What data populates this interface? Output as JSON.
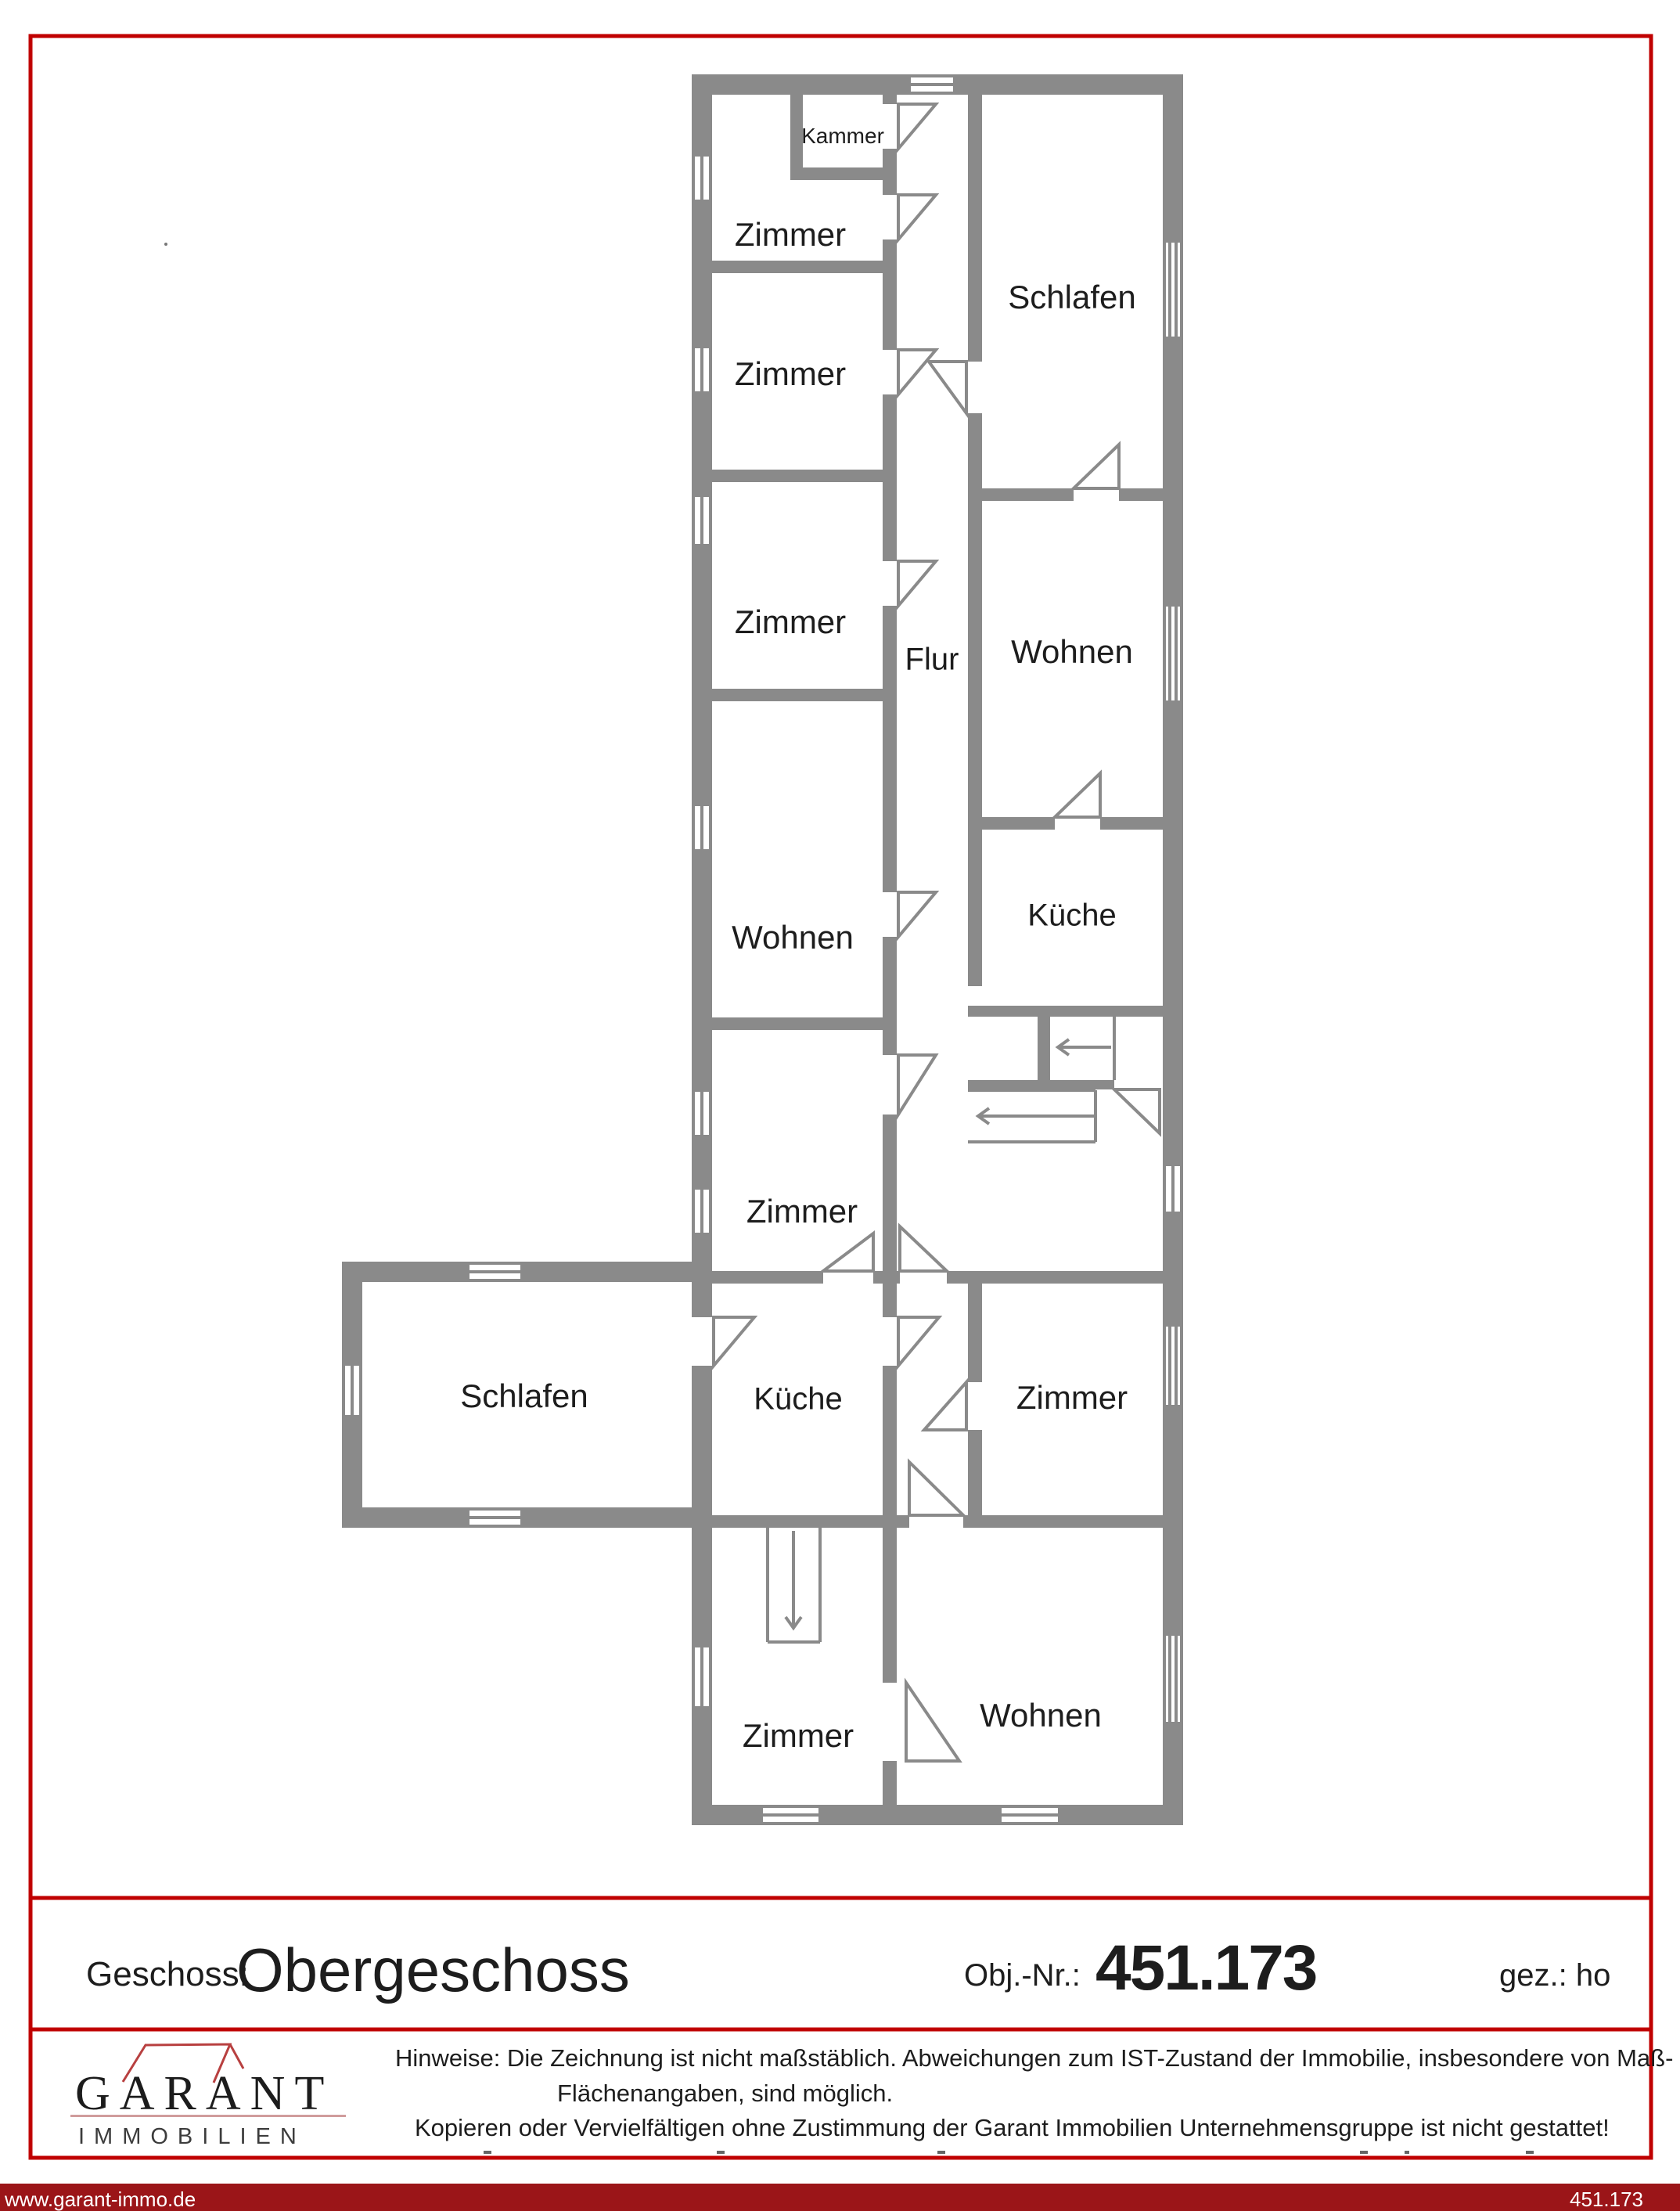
{
  "rooms": [
    {
      "label": "Kammer"
    },
    {
      "label": "Zimmer"
    },
    {
      "label": "Zimmer"
    },
    {
      "label": "Zimmer"
    },
    {
      "label": "Wohnen"
    },
    {
      "label": "Zimmer"
    },
    {
      "label": "Schlafen"
    },
    {
      "label": "Flur"
    },
    {
      "label": "Wohnen"
    },
    {
      "label": "Küche"
    },
    {
      "label": "Schlafen"
    },
    {
      "label": "Küche"
    },
    {
      "label": "Zimmer"
    },
    {
      "label": "Zimmer"
    },
    {
      "label": "Wohnen"
    }
  ],
  "title_block": {
    "geschoss_label": "Geschoss:",
    "geschoss_value": "Obergeschoss",
    "obj_nr_label": "Obj.-Nr.:",
    "obj_nr_value": "451.173",
    "gez_label": "gez.: ho"
  },
  "legal": {
    "hinweise_line1": "Hinweise: Die Zeichnung ist nicht maßstäblich. Abweichungen zum IST-Zustand der Immobilie, insbesondere von Maß- und",
    "hinweise_line2": "Flächenangaben, sind möglich.",
    "hinweise_line3": "Kopieren oder Vervielfältigen ohne Zustimmung der Garant Immobilien Unternehmensgruppe ist nicht gestattet!"
  },
  "logo": {
    "brand": "GARANT",
    "division": "IMMOBILIEN"
  },
  "bottom_bar": {
    "website": "www.garant-immo.de",
    "object_number": "451.173"
  },
  "colors": {
    "wall_gray": "#8a8a8a",
    "border_red": "#c00000",
    "bar_red": "#9b1518",
    "logo_roof_red": "#b84040"
  }
}
